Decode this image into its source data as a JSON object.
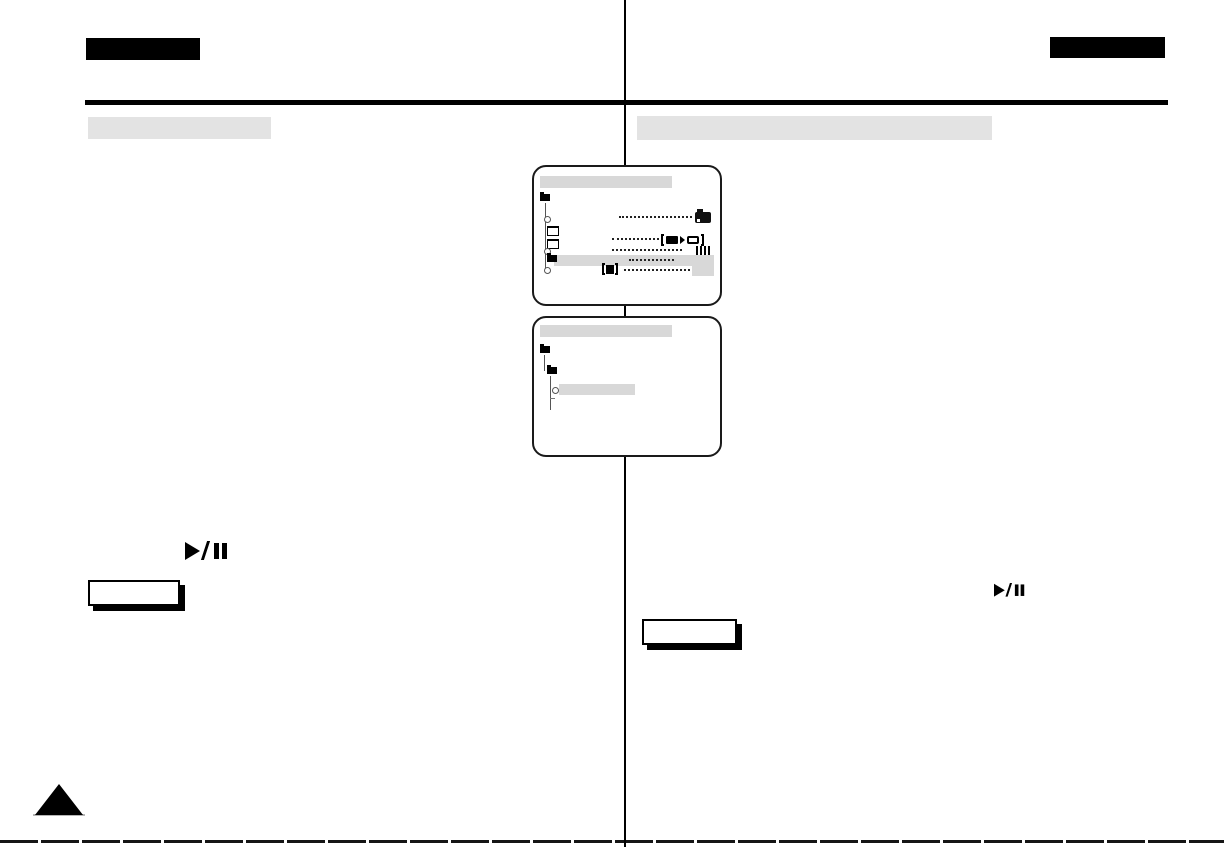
{
  "page": {
    "width": 1224,
    "height": 847,
    "background": "#ffffff",
    "kind": "scanned-manual-page"
  },
  "colors": {
    "ink": "#000000",
    "section_bar_gray": "#e3e3e3",
    "screen_title_gray": "#d8d8d8",
    "highlight_row_gray": "#d8d8d8",
    "value_box_gray": "#d8d8d8",
    "screen_border": "#1a1a1a",
    "note_shadow": "#000000"
  },
  "header": {
    "left_tab": {
      "shape": "solid-black-bar"
    },
    "right_tab": {
      "shape": "solid-black-bar"
    },
    "rule": {
      "shape": "horizontal-black-rule"
    }
  },
  "layout": {
    "columns": 2,
    "divider": "vertical-black-rule-center"
  },
  "sections": {
    "left_title_bar": {
      "shape": "gray-bar"
    },
    "right_title_bar": {
      "shape": "gray-bar"
    }
  },
  "screens": [
    {
      "name": "menu-screen-top",
      "kind": "camcorder-osd-menu",
      "title_bar": {
        "color": "#d8d8d8"
      },
      "tree": {
        "root": "folder-solid",
        "items": [
          {
            "node": "circle",
            "leader_dots": true,
            "trailing_icon": "camera-icon"
          },
          {
            "node": "folder-outline",
            "leader_dots": false
          },
          {
            "node": "folder-outline",
            "leader_dots": true,
            "trailing_icon": "tape-to-card-icon"
          },
          {
            "node": "circle",
            "leader_dots": true,
            "trailing_icon": "level-bars-icon"
          },
          {
            "node": "folder-solid",
            "leader_dots": true,
            "highlighted": true
          },
          {
            "node": "circle",
            "leading_icon": "bracket-m-icon",
            "leader_dots": true,
            "trailing_icon": "value-box"
          }
        ]
      }
    },
    {
      "name": "menu-screen-bottom",
      "kind": "camcorder-osd-menu",
      "title_bar": {
        "color": "#d8d8d8"
      },
      "tree": {
        "root": "folder-solid",
        "items": [
          {
            "node": "folder-solid"
          },
          {
            "node": "circle",
            "highlighted": true
          }
        ]
      }
    }
  ],
  "symbols": {
    "play_pause": "▶/❙❙"
  },
  "notes": {
    "left_box": {
      "shape": "outlined-box-with-drop-shadow"
    },
    "right_box": {
      "shape": "outlined-box-with-drop-shadow"
    }
  },
  "footer": {
    "page_marker": "black-triangle",
    "scan_artifact": "dashed-bottom-edge-line"
  }
}
